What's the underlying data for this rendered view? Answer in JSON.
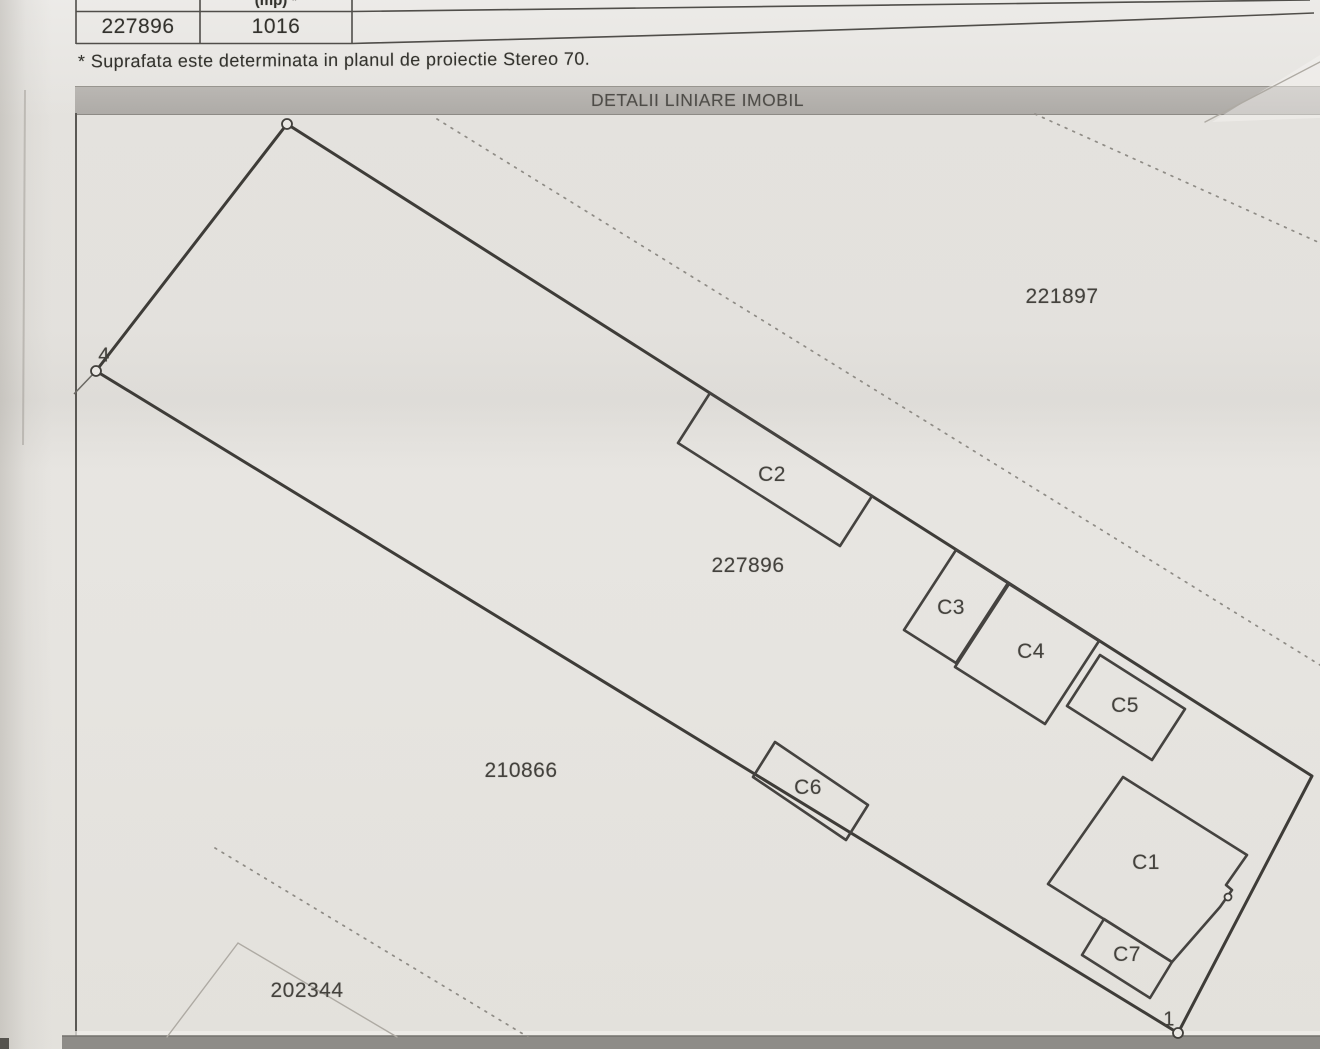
{
  "page": {
    "table": {
      "header_partial": "(mp) *",
      "row": {
        "parcel_id": "227896",
        "area": "1016"
      }
    },
    "note": "* Suprafata este determinata in planul de proiectie Stereo 70.",
    "map_title": "DETALII LINIARE IMOBIL"
  },
  "colors": {
    "paper": "#eae8e4",
    "boundary_ink": "#3e3c38",
    "building_ink": "#454340",
    "label_ink": "#44423d",
    "faint": "#8f8c86",
    "thin_faint": "#aeaaa3",
    "titlebar_bg": "#b4b1ad",
    "bottom_bar": "#8e8c88"
  },
  "map": {
    "parcel": {
      "id": "227896",
      "boundary": [
        [
          287,
          124
        ],
        [
          1312,
          776
        ],
        [
          1178,
          1033
        ],
        [
          96,
          371
        ]
      ],
      "tail_line": [
        [
          96,
          371
        ],
        [
          74,
          394
        ]
      ],
      "vertices": [
        {
          "text": "4",
          "x": 96,
          "y": 371,
          "r": 5,
          "label_x": 104,
          "label_y": 356
        },
        {
          "text": "1",
          "x": 1178,
          "y": 1033,
          "r": 5,
          "label_x": 1169,
          "label_y": 1020
        },
        {
          "text": "",
          "x": 287,
          "y": 124,
          "r": 5
        },
        {
          "text": "",
          "x": 1228,
          "y": 897,
          "r": 3.5
        }
      ]
    },
    "buildings": [
      {
        "id": "C1",
        "label_x": 1146,
        "label_y": 863,
        "points": [
          [
            1123,
            777
          ],
          [
            1247,
            855
          ],
          [
            1226,
            885
          ],
          [
            1232,
            890
          ],
          [
            1220,
            907
          ],
          [
            1172,
            962
          ],
          [
            1048,
            884
          ]
        ]
      },
      {
        "id": "C2",
        "label_x": 772,
        "label_y": 475,
        "points": [
          [
            710,
            393
          ],
          [
            872,
            496
          ],
          [
            840,
            546
          ],
          [
            678,
            443
          ]
        ]
      },
      {
        "id": "C3",
        "label_x": 951,
        "label_y": 608,
        "points": [
          [
            956,
            550
          ],
          [
            1008,
            583
          ],
          [
            956,
            663
          ],
          [
            904,
            630
          ]
        ]
      },
      {
        "id": "C4",
        "label_x": 1031,
        "label_y": 652,
        "points": [
          [
            1009,
            584
          ],
          [
            1099,
            641
          ],
          [
            1045,
            724
          ],
          [
            955,
            667
          ]
        ]
      },
      {
        "id": "C5",
        "label_x": 1125,
        "label_y": 706,
        "points": [
          [
            1100,
            655
          ],
          [
            1185,
            709
          ],
          [
            1152,
            760
          ],
          [
            1067,
            706
          ]
        ]
      },
      {
        "id": "C6",
        "label_x": 808,
        "label_y": 788,
        "points": [
          [
            775,
            742
          ],
          [
            868,
            805
          ],
          [
            846,
            840
          ],
          [
            753,
            777
          ]
        ]
      },
      {
        "id": "C7",
        "label_x": 1127,
        "label_y": 955,
        "points": [
          [
            1104,
            919
          ],
          [
            1172,
            962
          ],
          [
            1150,
            998
          ],
          [
            1082,
            955
          ]
        ]
      }
    ],
    "neighbor_labels": [
      {
        "text": "221897",
        "x": 1062,
        "y": 297
      },
      {
        "text": "227896",
        "x": 748,
        "y": 566
      },
      {
        "text": "210866",
        "x": 521,
        "y": 771
      },
      {
        "text": "202344",
        "x": 307,
        "y": 991
      }
    ],
    "faint_lines": [
      {
        "style": "dotted",
        "points": [
          [
            437,
            119
          ],
          [
            1320,
            665
          ]
        ]
      },
      {
        "style": "dotted",
        "points": [
          [
            1035,
            114
          ],
          [
            1320,
            243
          ]
        ]
      },
      {
        "style": "dotted",
        "points": [
          [
            215,
            848
          ],
          [
            528,
            1037
          ]
        ]
      },
      {
        "style": "thin",
        "points": [
          [
            167,
            1037
          ],
          [
            238,
            943
          ],
          [
            397,
            1037
          ]
        ]
      },
      {
        "style": "thin",
        "points": [
          [
            1205,
            122
          ],
          [
            1320,
            62
          ]
        ]
      }
    ]
  }
}
